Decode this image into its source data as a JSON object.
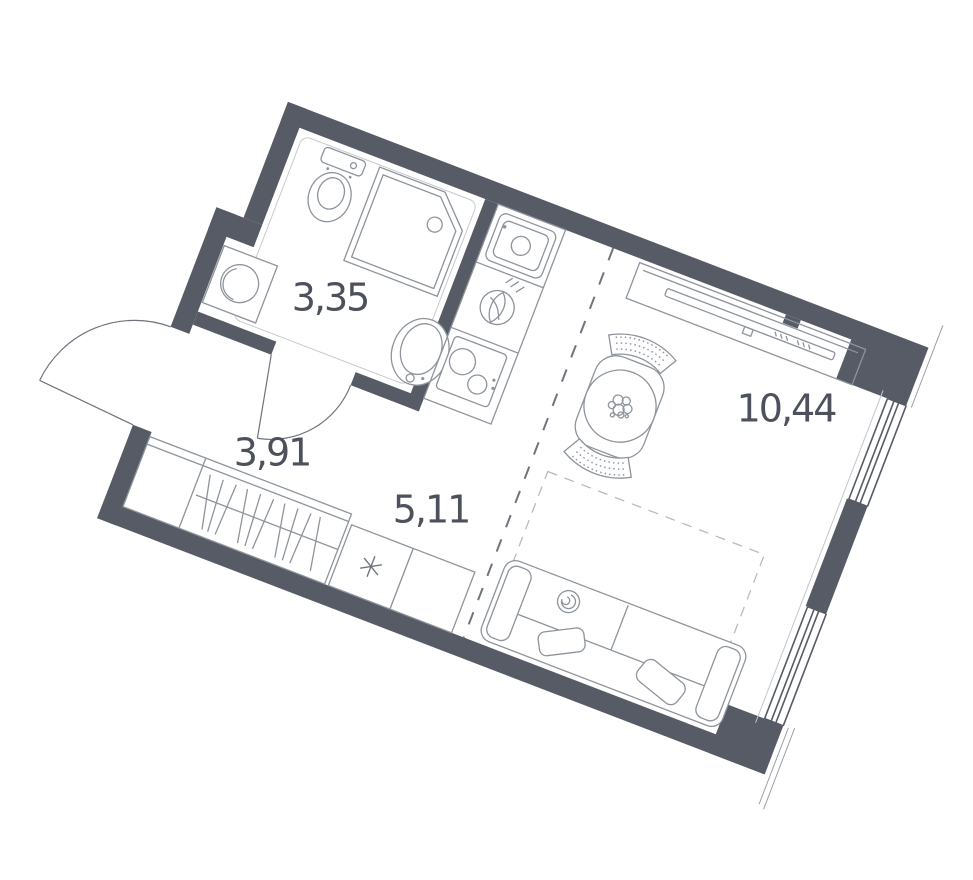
{
  "plan": {
    "title": "studio-apartment-floor-plan",
    "rooms": [
      {
        "name": "bathroom",
        "area": "3,35"
      },
      {
        "name": "hallway",
        "area": "3,91"
      },
      {
        "name": "kitchen",
        "area": "5,11"
      },
      {
        "name": "living-room",
        "area": "10,44"
      }
    ],
    "colors": {
      "wall": "#565b66",
      "fixture_line": "#8e949c",
      "label": "#4c515c",
      "zone_dash": "#6f747d",
      "light_line": "#c6cad0"
    },
    "icons": [
      "toilet-icon",
      "shower-icon",
      "washbasin-icon",
      "washing-machine-icon",
      "kitchen-sink-icon",
      "burner-icon",
      "hob-icon",
      "fridge-icon",
      "wardrobe-icon",
      "dining-table-icon",
      "chair-icon",
      "tv-console-icon",
      "sofa-bed-icon",
      "entry-door-icon",
      "bathroom-door-icon",
      "window-icon"
    ]
  }
}
